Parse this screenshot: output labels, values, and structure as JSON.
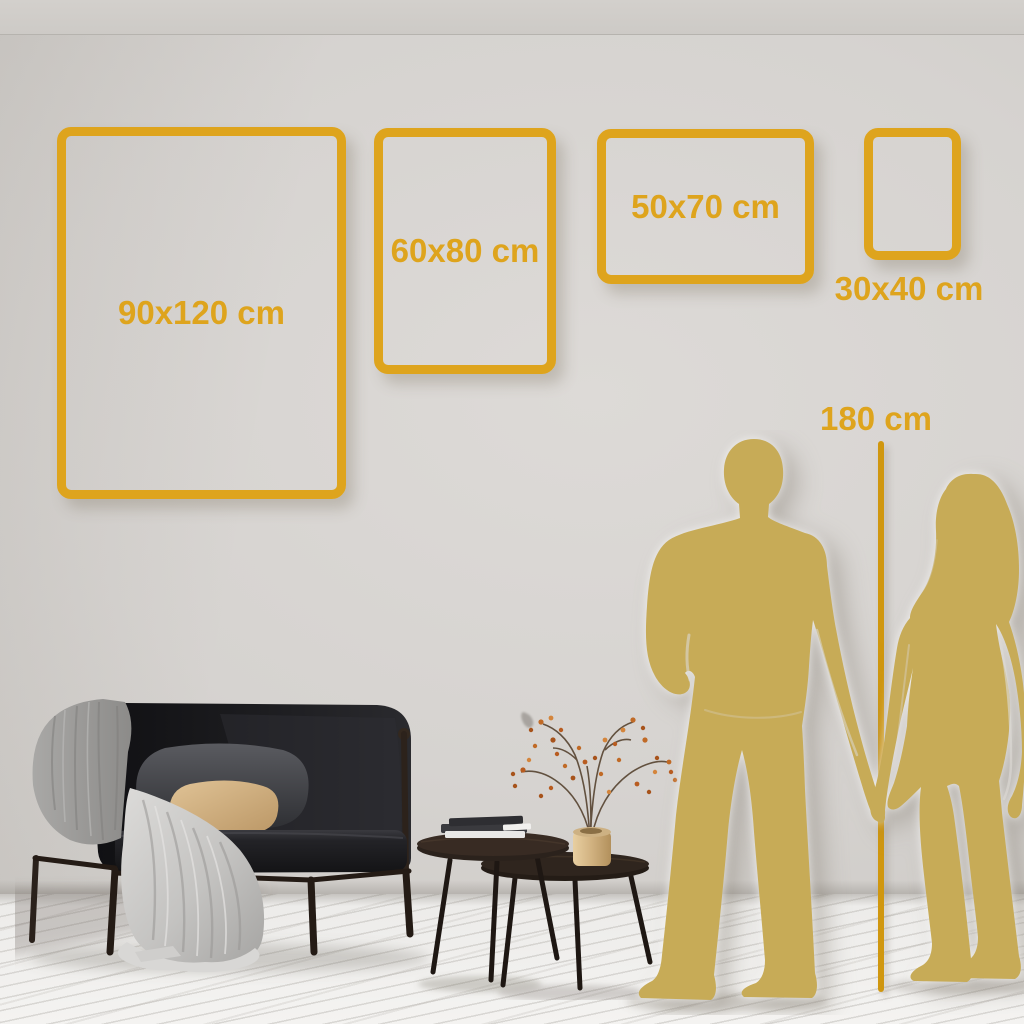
{
  "size_guide": {
    "frames": [
      {
        "label": "90x120 cm"
      },
      {
        "label": "60x80 cm"
      },
      {
        "label": "50x70 cm"
      },
      {
        "label": "30x40 cm"
      }
    ],
    "height_marker": {
      "label": "180 cm"
    }
  },
  "colors": {
    "accent_gold": "#DEA41D",
    "marker_line_gold": "#D0970F",
    "silhouette_gold": "#C7AB57",
    "wall": "#D6D3D0",
    "floor": "#F0EFED"
  }
}
